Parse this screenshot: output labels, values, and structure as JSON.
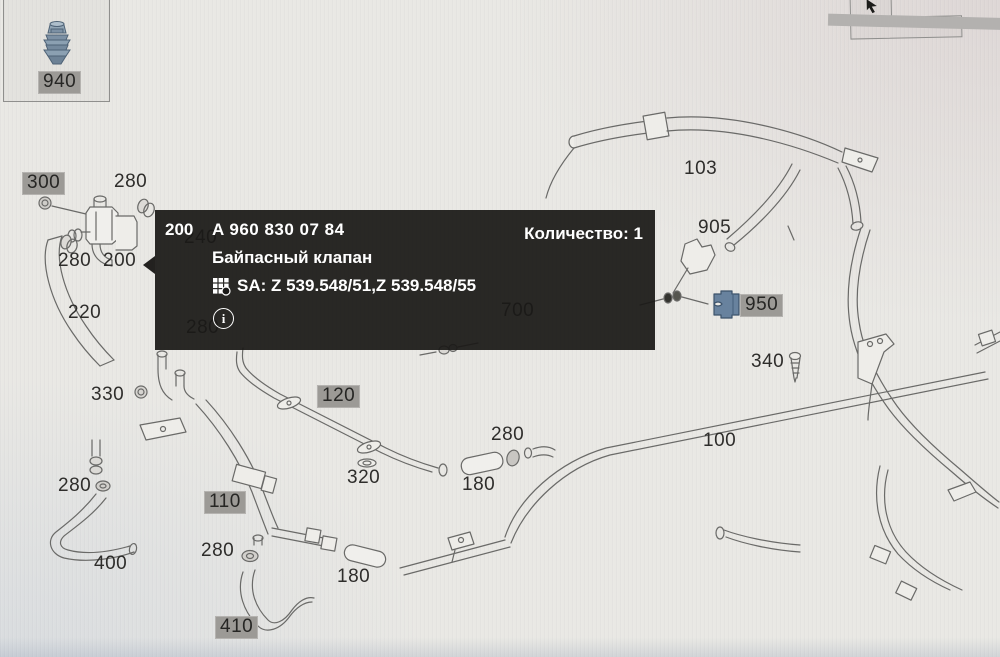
{
  "diagram": {
    "description": "parts-catalog-pipes-diagram",
    "thumbnail": {
      "label": "940",
      "icon": "plug-part-icon"
    },
    "tooltip": {
      "position": "200",
      "part_number": "A 960 830 07 84",
      "quantity_text": "Количество: 1",
      "part_name": "Байпасный клапан",
      "sa_text": "SA: Z 539.548/51,Z 539.548/55",
      "info_glyph": "i"
    },
    "labels": {
      "plain": [
        {
          "text": "280",
          "x": 114,
          "y": 172
        },
        {
          "text": "280",
          "x": 58,
          "y": 251
        },
        {
          "text": "200",
          "x": 103,
          "y": 251
        },
        {
          "text": "220",
          "x": 68,
          "y": 303
        },
        {
          "text": "330",
          "x": 91,
          "y": 385
        },
        {
          "text": "280",
          "x": 58,
          "y": 476
        },
        {
          "text": "400",
          "x": 94,
          "y": 554
        },
        {
          "text": "280",
          "x": 201,
          "y": 541
        },
        {
          "text": "320",
          "x": 347,
          "y": 468
        },
        {
          "text": "180",
          "x": 462,
          "y": 475
        },
        {
          "text": "280",
          "x": 491,
          "y": 425
        },
        {
          "text": "180",
          "x": 337,
          "y": 567
        },
        {
          "text": "100",
          "x": 703,
          "y": 431
        },
        {
          "text": "103",
          "x": 684,
          "y": 159
        },
        {
          "text": "905",
          "x": 698,
          "y": 218
        },
        {
          "text": "340",
          "x": 751,
          "y": 352
        }
      ],
      "under_tooltip": [
        {
          "text": "240",
          "x": 184,
          "y": 228
        },
        {
          "text": "280",
          "x": 186,
          "y": 318
        },
        {
          "text": "700",
          "x": 501,
          "y": 301
        }
      ],
      "highlighted": [
        {
          "text": "300",
          "x": 22,
          "y": 172
        },
        {
          "text": "110",
          "x": 204,
          "y": 491
        },
        {
          "text": "410",
          "x": 215,
          "y": 616
        },
        {
          "text": "120",
          "x": 317,
          "y": 385
        },
        {
          "text": "950",
          "x": 740,
          "y": 294
        }
      ]
    },
    "colors": {
      "tooltip_bg": "#1a1917",
      "label_highlight_bg": "#9c9a96",
      "part_blue": "#68829e",
      "line_art": "#6a6a68",
      "background": "#e9e8e4"
    }
  }
}
